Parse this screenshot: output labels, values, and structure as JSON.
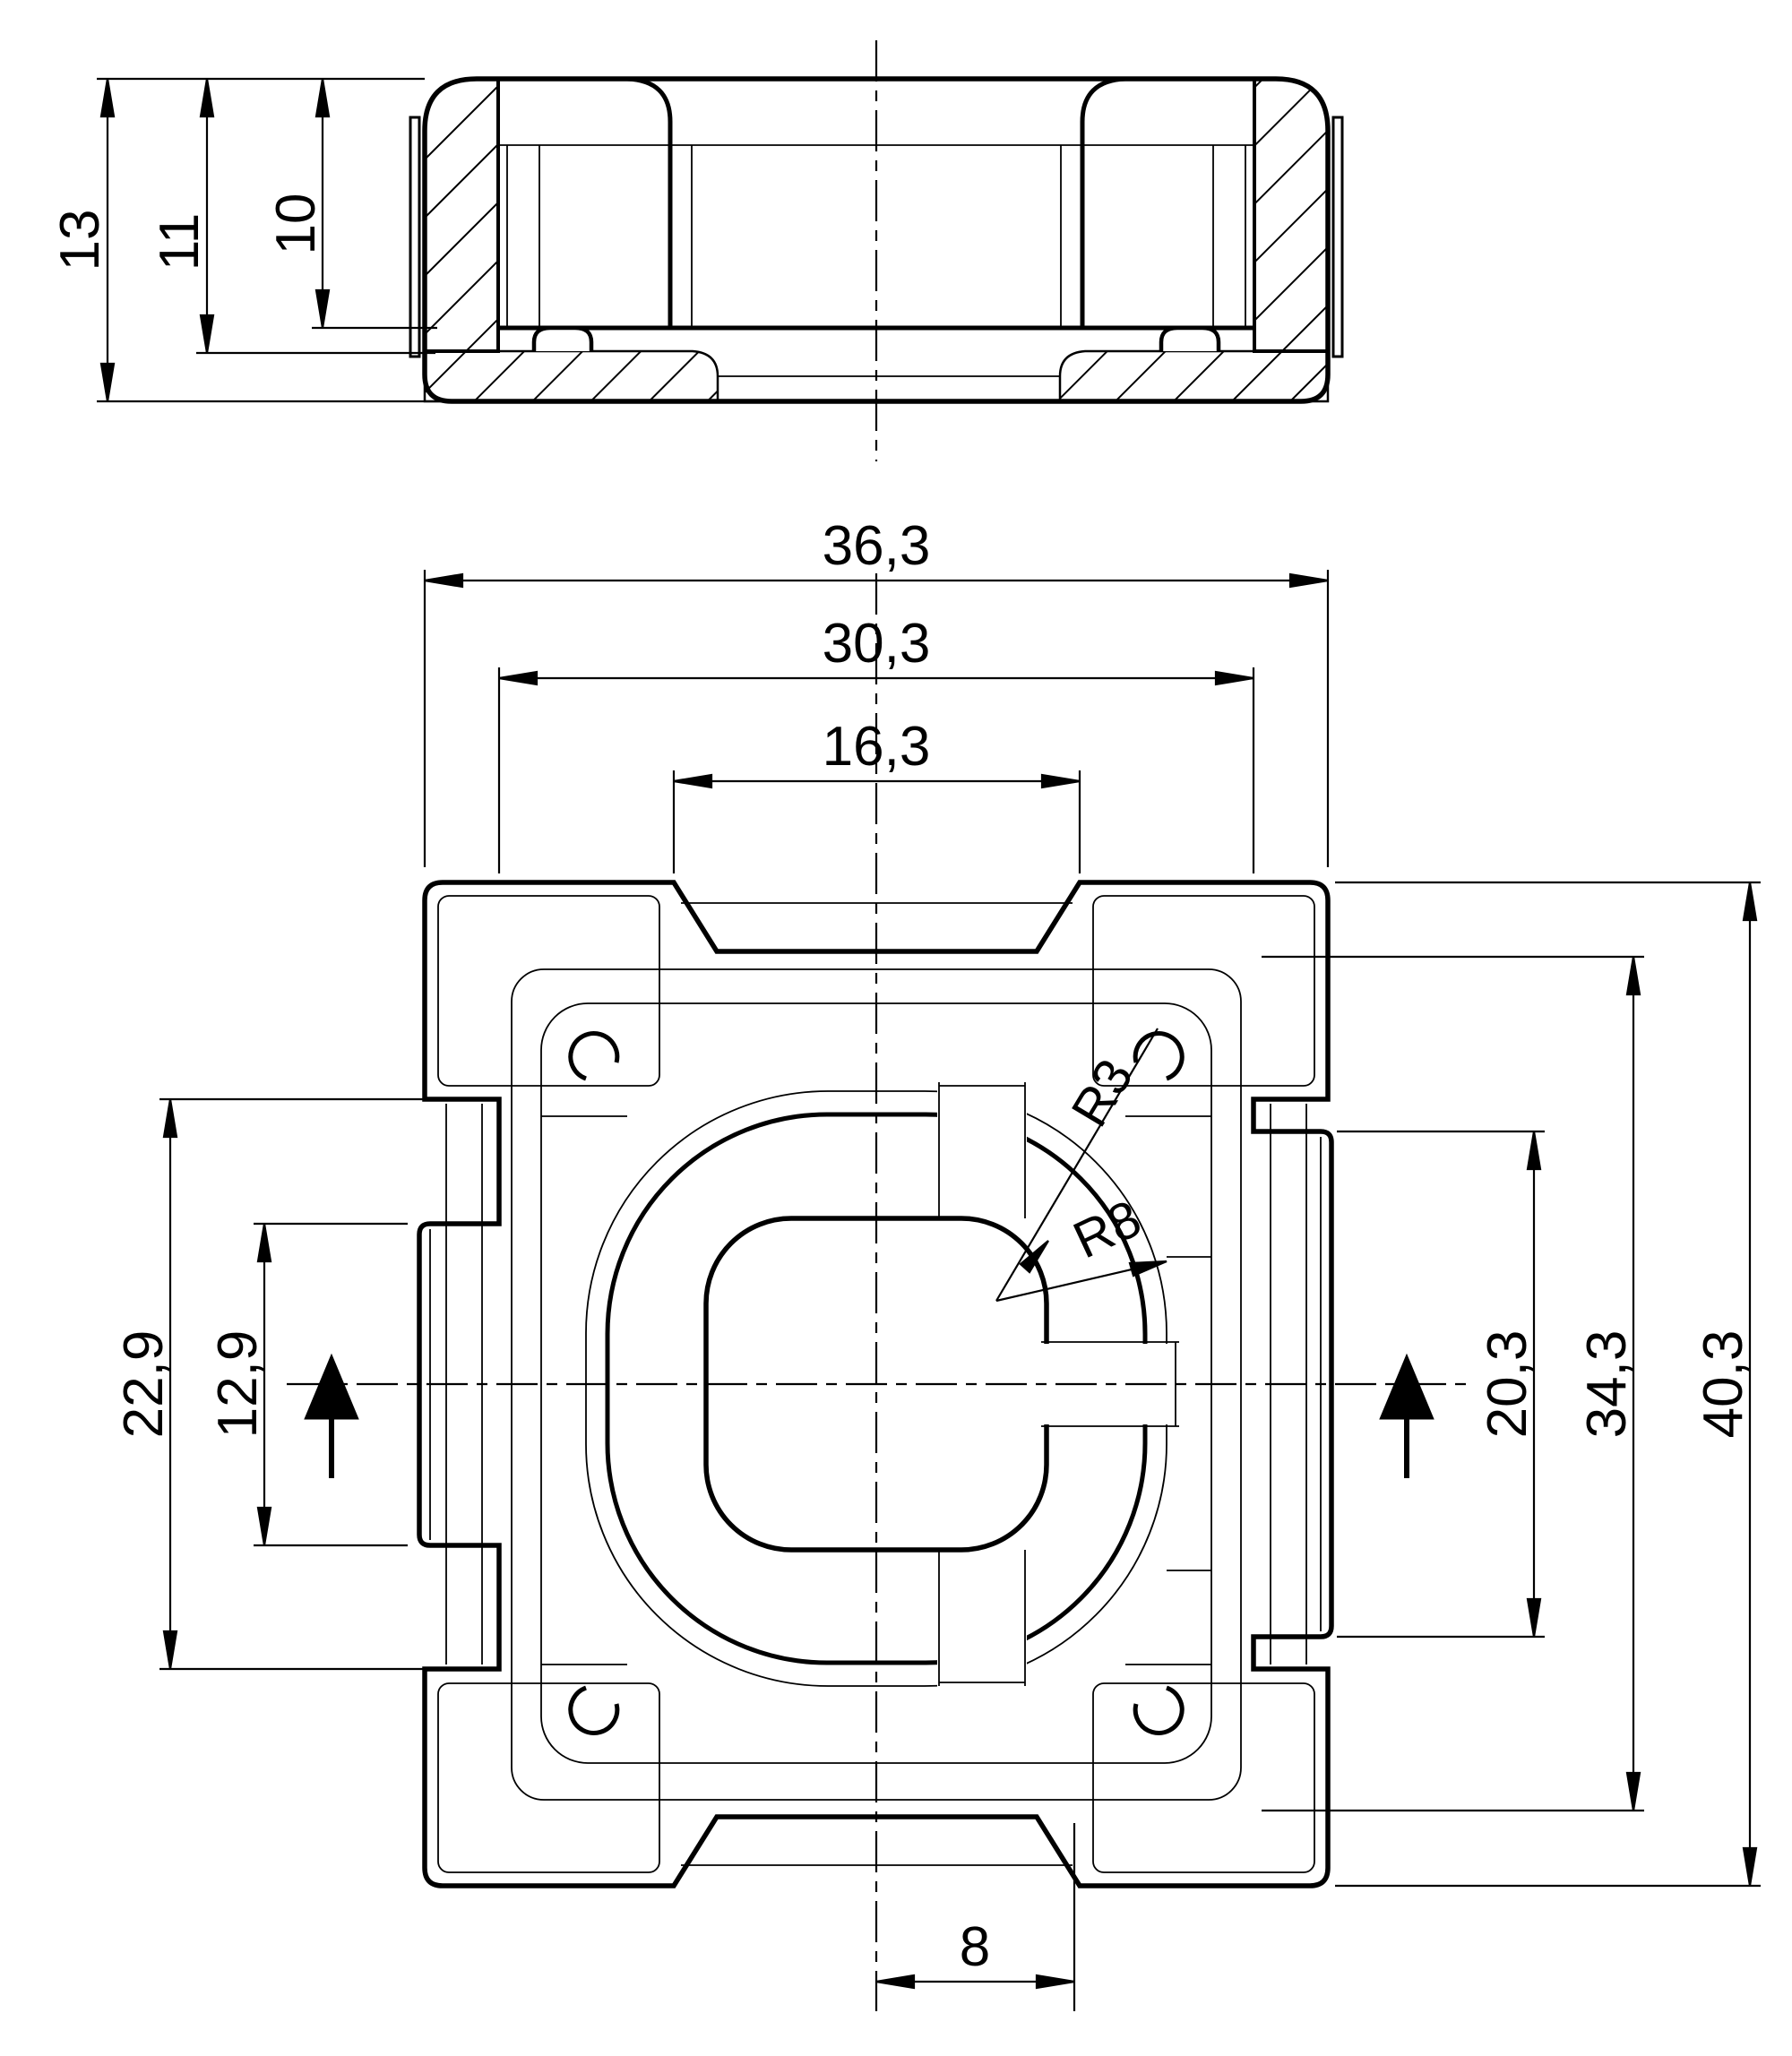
{
  "drawing": {
    "type": "technical-drawing",
    "colors": {
      "background": "#ffffff",
      "line": "#000000"
    },
    "section_view": {
      "dimensions": {
        "height_total": "13",
        "height_upper": "11",
        "depth_pocket": "10"
      }
    },
    "plan_view": {
      "dimensions_top": {
        "overall_width": "36,3",
        "body_width": "30,3",
        "notch_width": "16,3"
      },
      "dimensions_left": {
        "side_notch_height": "22,9",
        "left_tab_height": "12,9"
      },
      "dimensions_right": {
        "right_tab_height": "20,3",
        "body_height": "34,3",
        "overall_height": "40,3"
      },
      "dimensions_bottom": {
        "half_notch_width": "8"
      },
      "radii": {
        "pocket_corner": "R3",
        "boss_corner": "R8"
      }
    }
  }
}
